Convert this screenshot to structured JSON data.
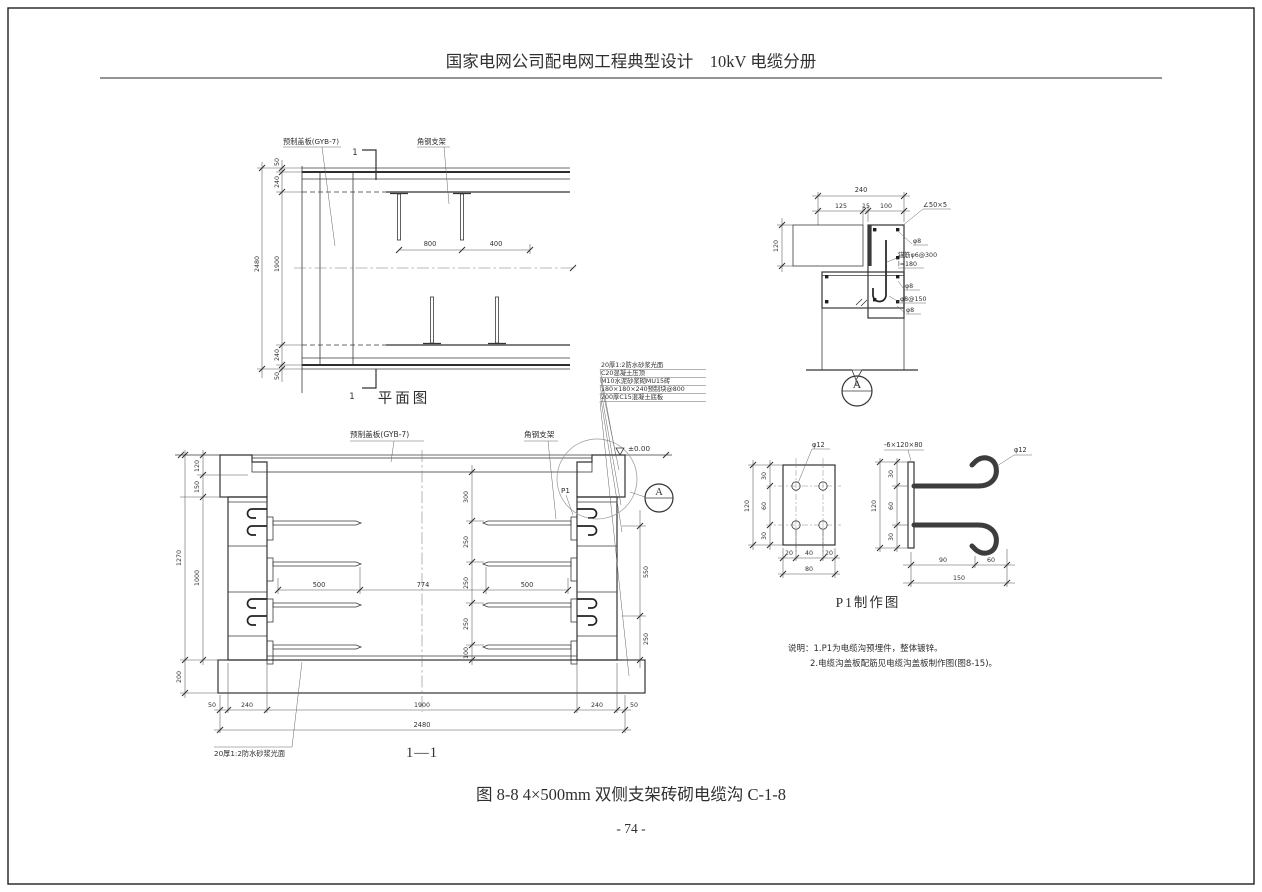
{
  "header": {
    "title": "国家电网公司配电网工程典型设计　10kV 电缆分册"
  },
  "plan": {
    "title": "平面图",
    "cover_plate_label": "预制盖板(GYB-7)",
    "bracket_label": "角钢支架",
    "section_mark": "1",
    "dims": {
      "lip_top": "50",
      "wall_top": "240",
      "total": "2480",
      "inner": "1900",
      "spacing": "800",
      "offset": "400",
      "wall_bottom": "240",
      "lip_bottom": "50"
    }
  },
  "detail_a": {
    "bubble": "A",
    "dims": {
      "total": "240",
      "a": "125",
      "b": "15",
      "c": "100",
      "height": "120"
    },
    "labels": {
      "angle": "∠50×5",
      "rebar_top": "φ8",
      "anchor1": "锚筋φ6@300",
      "anchor2": "l=180",
      "rebar_mid": "φ8",
      "stirrup": "φ8@150",
      "rebar_bottom": "φ8"
    }
  },
  "section": {
    "title": "1—1",
    "cover_plate_label": "预制盖板(GYB-7)",
    "bracket_label": "角钢支架",
    "level_label": "±0.00",
    "p1_label": "P1",
    "bubble": "A",
    "callouts": [
      "20厚1:2防水砂浆光面",
      "C20混凝土压顶",
      "M10水泥砂浆砌MU15砖",
      "180×180×240预制块@800",
      "200厚C15混凝土底板"
    ],
    "floor_label": "20厚1:2防水砂浆光面",
    "dims": {
      "cover": "120",
      "coping": "150",
      "wall_height": "1000",
      "inner_height": "1270",
      "slab": "200",
      "shelf_left": "500",
      "clear": "774",
      "shelf_right": "500",
      "top_gap": "300",
      "s1": "250",
      "s2": "250",
      "s3": "250",
      "s4": "100",
      "hook_span": "550",
      "hook_bottom": "250",
      "lip_left": "50",
      "wall_left": "240",
      "inner_width": "1900",
      "wall_right": "240",
      "lip_right": "50",
      "total_width": "2480"
    }
  },
  "p1": {
    "title": "P1制作图",
    "plate_hole_label": "φ12",
    "plate_size_label": "-6×120×80",
    "hook_label": "φ12",
    "dims": {
      "pv1": "30",
      "pv2": "60",
      "pv3": "30",
      "pv": "120",
      "ph1": "20",
      "ph2": "40",
      "ph3": "20",
      "ph": "80",
      "hv1": "30",
      "hv2": "60",
      "hv3": "30",
      "hv": "120",
      "hh1": "90",
      "hh2": "60",
      "hh": "150"
    }
  },
  "notes": {
    "line1": "说明：1.P1为电缆沟预埋件，整体镀锌。",
    "line2": "2.电缆沟盖板配筋见电缆沟盖板制作图(图8-15)。"
  },
  "footer": {
    "caption": "图 8-8 4×500mm 双侧支架砖砌电缆沟 C-1-8",
    "page_number": "- 74 -"
  }
}
